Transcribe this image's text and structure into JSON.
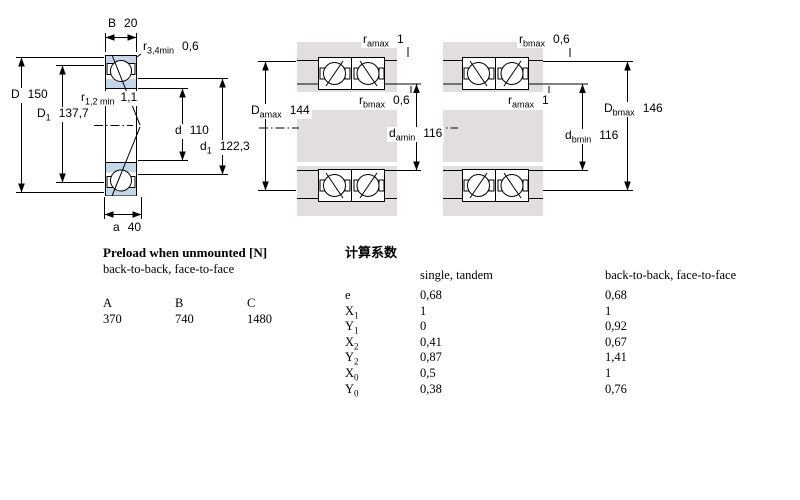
{
  "diagram": {
    "dims": {
      "B": {
        "sym": "B",
        "sub": "",
        "value": "20"
      },
      "r34": {
        "sym": "r",
        "sub": "3,4min",
        "value": "0,6"
      },
      "D": {
        "sym": "D",
        "sub": "",
        "value": "150"
      },
      "D1": {
        "sym": "D",
        "sub": "1",
        "value": "137,7"
      },
      "r12": {
        "sym": "r",
        "sub": "1,2 min",
        "value": "1,1"
      },
      "d": {
        "sym": "d",
        "sub": "",
        "value": "110"
      },
      "d1": {
        "sym": "d",
        "sub": "1",
        "value": "122,3"
      },
      "a": {
        "sym": "a",
        "sub": "",
        "value": "40"
      },
      "m_ramax": {
        "sym": "r",
        "sub": "amax",
        "value": "1"
      },
      "m_rbmax": {
        "sym": "r",
        "sub": "bmax",
        "value": "0,6"
      },
      "m_Damax": {
        "sym": "D",
        "sub": "amax",
        "value": "144"
      },
      "m_damin": {
        "sym": "d",
        "sub": "amin",
        "value": "116"
      },
      "r_rbmax": {
        "sym": "r",
        "sub": "bmax",
        "value": "0,6"
      },
      "r_ramax": {
        "sym": "r",
        "sub": "amax",
        "value": "1"
      },
      "r_Dbmax": {
        "sym": "D",
        "sub": "bmax",
        "value": "146"
      },
      "r_dbmin": {
        "sym": "d",
        "sub": "bmin",
        "value": "116"
      }
    }
  },
  "preload": {
    "title": "Preload when unmounted [N]",
    "subtitle": "back-to-back, face-to-face",
    "columns": [
      "A",
      "B",
      "C"
    ],
    "values": [
      "370",
      "740",
      "1480"
    ]
  },
  "factors": {
    "title": "计算系数",
    "col1_header": "single, tandem",
    "col2_header": "back-to-back, face-to-face",
    "rows": [
      {
        "sym": "e",
        "sub": "",
        "single": "0,68",
        "btb": "0,68"
      },
      {
        "sym": "X",
        "sub": "1",
        "single": "1",
        "btb": "1"
      },
      {
        "sym": "Y",
        "sub": "1",
        "single": "0",
        "btb": "0,92"
      },
      {
        "sym": "X",
        "sub": "2",
        "single": "0,41",
        "btb": "0,67"
      },
      {
        "sym": "Y",
        "sub": "2",
        "single": "0,87",
        "btb": "1,41"
      },
      {
        "sym": "X",
        "sub": "0",
        "single": "0,5",
        "btb": "1"
      },
      {
        "sym": "Y",
        "sub": "0",
        "single": "0,38",
        "btb": "0,76"
      }
    ]
  },
  "colors": {
    "ring_blue": "#c5d5ea",
    "metal_gray": "#e2dede",
    "line": "#000000"
  }
}
